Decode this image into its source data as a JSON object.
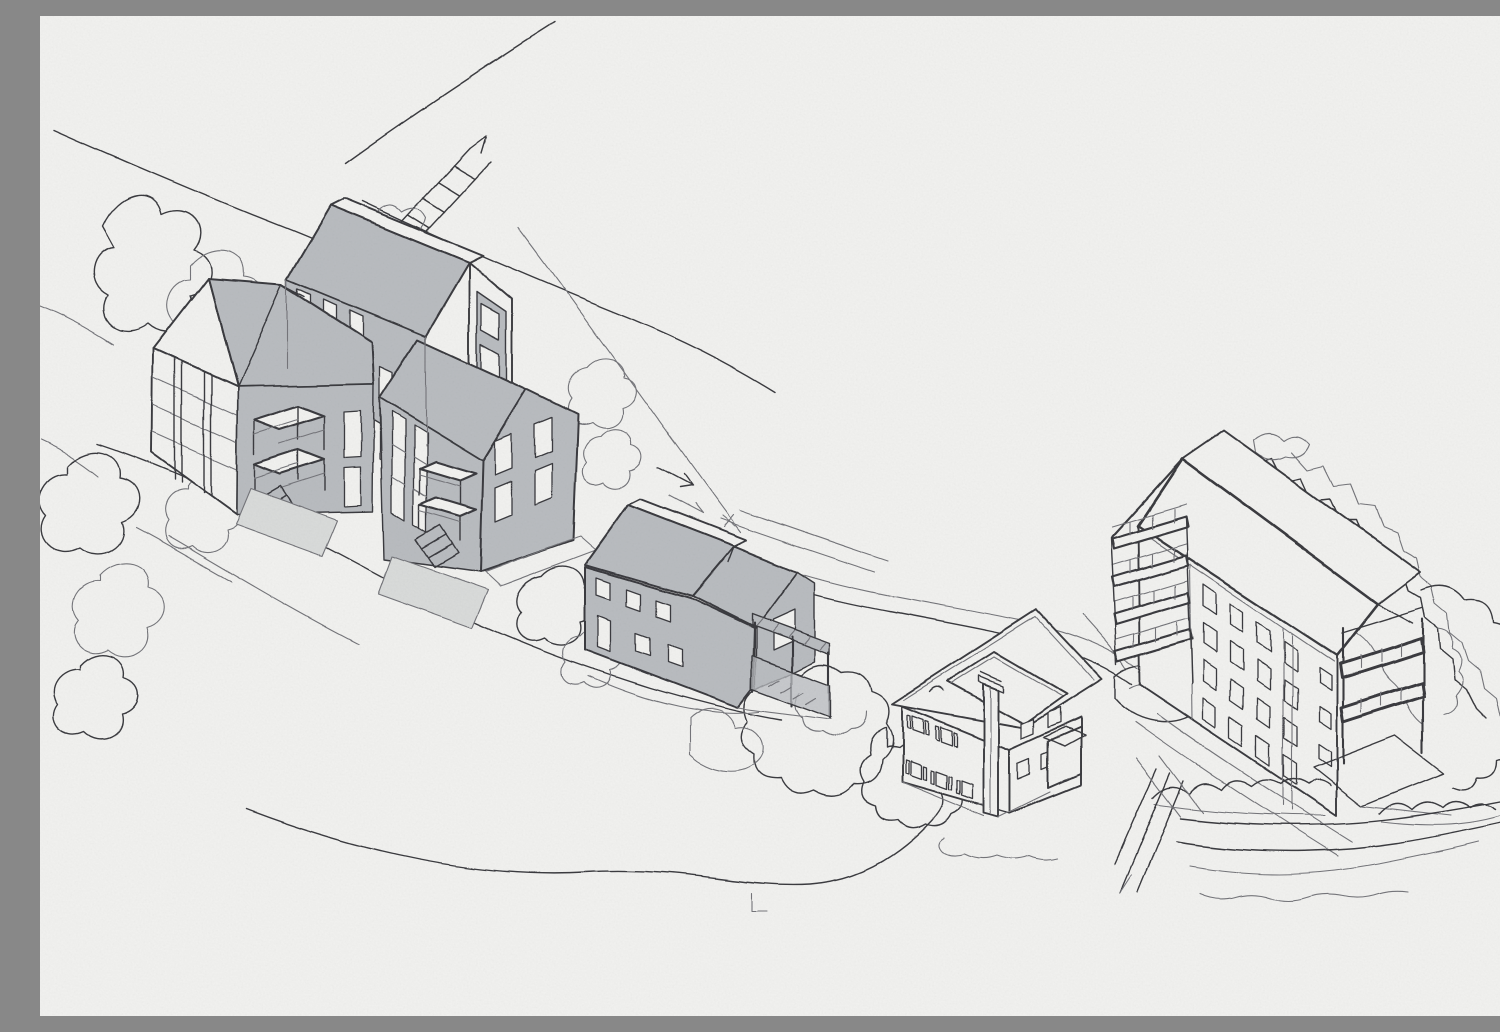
{
  "meta": {
    "title": "Architectural site sketch",
    "description": "Hand-drawn axonometric ink sketch on textured paper showing a hillside housing site: a cluster of three gabled apartment blocks with shaded roofs and courtyard balconies at upper left, a small fully shaded outbuilding with pergola at center, an existing two-storey house with tall chimney at center right, and a four-storey apartment block with stacked balconies at the right, surrounded by contour lines, roads, scribbled trees and hedges.",
    "medium": "ink line work with flat grey marker shading",
    "view": "axonometric / bird's-eye sketch"
  },
  "colors": {
    "paper": "#f1f1ef",
    "paper_dark": "#e7e7e4",
    "ink": "#3a3b3f",
    "ink_light": "#74757a",
    "shade": "#b9bcc0",
    "shade_light": "#d9dbda"
  },
  "buildings": [
    {
      "id": "left-cluster",
      "label": "Left apartment cluster",
      "floors": 4,
      "shaded": true,
      "description": "Three connected gabled blocks with grey roofs, window strips, two stacked balcony bays with external stairs and terraces"
    },
    {
      "id": "middle-building",
      "label": "Middle outbuilding",
      "floors": 2,
      "shaded": true,
      "description": "Low gabled building fully shaded grey with stepped roof and attached pergola deck"
    },
    {
      "id": "house",
      "label": "Existing house",
      "floors": 2,
      "shaded": false,
      "description": "Cross-gabled house with tall chimney, shuttered windows and small porch"
    },
    {
      "id": "right-building",
      "label": "Right apartment block",
      "floors": 4,
      "shaded": false,
      "description": "Gabled four-storey block, window grid facade, four balcony slabs on the left gable end and a two-storey balcony frame on the right gable end with patio"
    }
  ],
  "site_features": [
    "diagonal roads and boundary lines upper left",
    "small staircase mark upper left",
    "looping tree and shrub scribbles along the left edge",
    "terrain contour lines sweeping under the buildings",
    "two round scribbled trees at center",
    "zig-zag tree line descending the right slope",
    "scalloped hedges and layered road lines at bottom right",
    "arrow ticks and survey marks"
  ]
}
